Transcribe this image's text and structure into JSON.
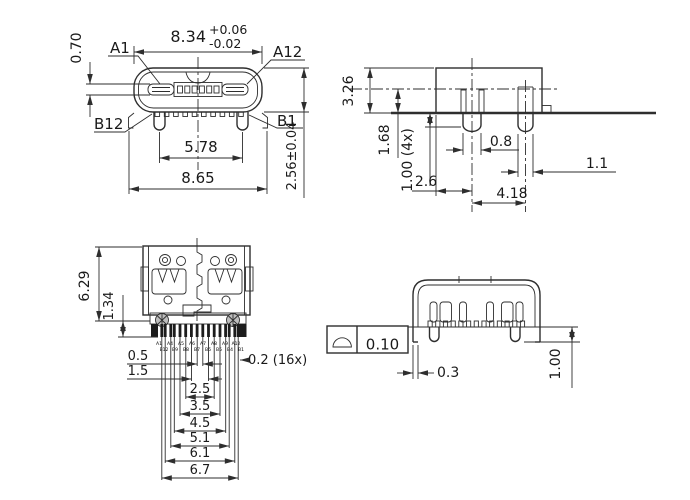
{
  "front_view": {
    "dim_width_main": "8.34",
    "dim_width_tol_plus": "+0.06",
    "dim_width_tol_minus": "-0.02",
    "pin_a1": "A1",
    "pin_a12": "A12",
    "pin_b12": "B12",
    "pin_b1": "B1",
    "dim_tongue_thickness": "0.70",
    "dim_leg_span": "5.78",
    "dim_overall_width": "8.65",
    "dim_height": "2.56±0.04"
  },
  "side_view": {
    "dim_height": "3.26",
    "dim_center_height": "1.68",
    "dim_leg_length": "1.00 (4x)",
    "dim_leg_width": "0.8",
    "dim_rear_leg_width": "1.1",
    "dim_leg_offset": "2.6",
    "dim_leg_spacing": "4.18"
  },
  "top_view": {
    "dim_depth": "6.29",
    "dim_tail_length": "1.34",
    "dim_pad_width": "0.2 (16x)",
    "ladder": [
      "0.5",
      "1.5",
      "2.5",
      "3.5",
      "4.5",
      "5.1",
      "6.1",
      "6.7"
    ],
    "pin_labels_row1": [
      "A1",
      "A4",
      "A5",
      "A6",
      "A7",
      "A8",
      "A9",
      "A12"
    ],
    "pin_labels_row2": [
      "B12",
      "B9",
      "B8",
      "B7",
      "B6",
      "B5",
      "B4",
      "B1"
    ]
  },
  "rear_view": {
    "coplanarity_symbol": "profile-of-surface-icon",
    "coplanarity_value": "0.10",
    "dim_lead_width": "0.3",
    "dim_leg_height": "1.00"
  },
  "colors": {
    "line": "#2e2e2e",
    "background": "#ffffff"
  }
}
